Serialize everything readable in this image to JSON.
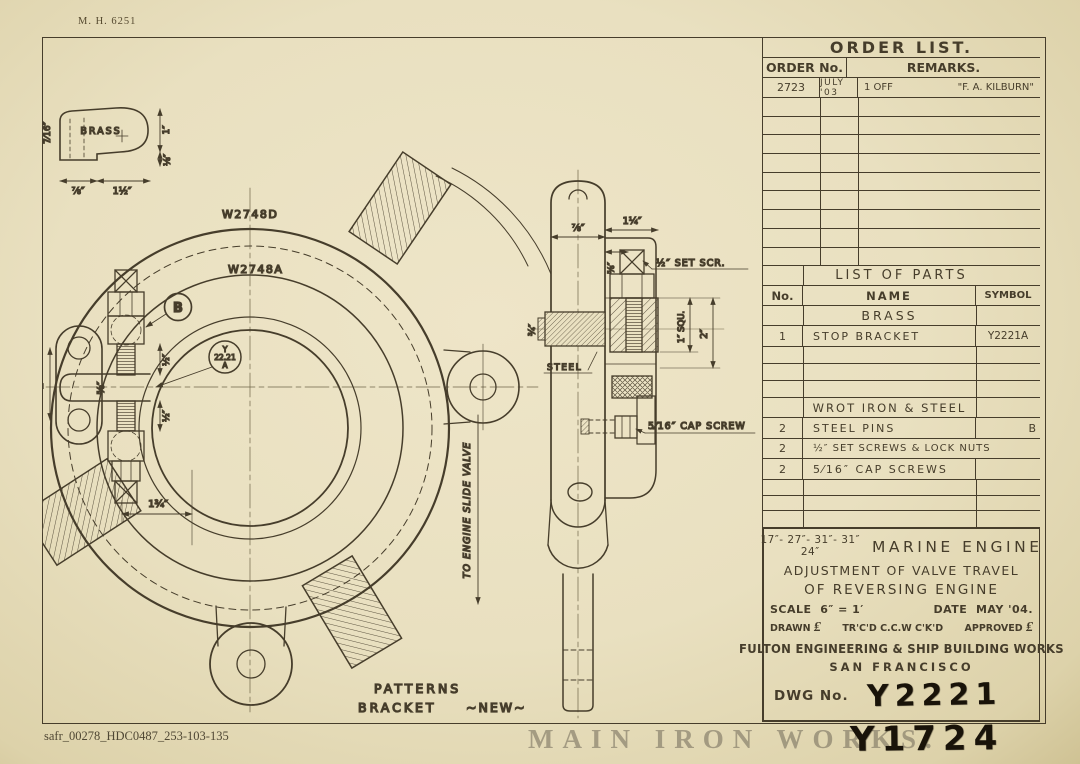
{
  "sheet": {
    "corner_number": "M. H. 6251",
    "archive_code": "safr_00278_HDC0487_253-103-135",
    "watermark": "MAIN IRON WORKS.",
    "stamp_secondary": "Y1724"
  },
  "order_list": {
    "title": "ORDER LIST.",
    "col_order": "ORDER No.",
    "col_remarks": "REMARKS.",
    "entry": {
      "order_no": "2723",
      "date": "JULY '03",
      "qty": "1 OFF",
      "remark": "\"F. A. KILBURN\""
    }
  },
  "parts_list": {
    "title": "LIST OF PARTS",
    "col_no": "No.",
    "col_name": "NAME",
    "col_symbol": "SYMBOL",
    "brass_section": "BRASS",
    "brass_rows": [
      {
        "no": "1",
        "name": "STOP BRACKET",
        "symbol": "Y2221A"
      }
    ],
    "steel_section": "WROT IRON & STEEL",
    "steel_rows": [
      {
        "no": "2",
        "name": "STEEL PINS",
        "symbol": "B"
      },
      {
        "no": "2",
        "name": "½″ SET SCREWS & LOCK NUTS",
        "symbol": ""
      },
      {
        "no": "2",
        "name": "5⁄16″ CAP SCREWS",
        "symbol": ""
      }
    ]
  },
  "title_block": {
    "sizes_top": "17″- 27″- 31″- 31″",
    "sizes_bottom": "24″",
    "machine": "MARINE ENGINE",
    "subject_line1": "ADJUSTMENT OF VALVE TRAVEL",
    "subject_line2": "OF REVERSING ENGINE",
    "scale_label": "SCALE",
    "scale_value": "6″ = 1′",
    "date_label": "DATE",
    "date_value": "MAY '04.",
    "drawn_label": "DRAWN",
    "drawn_sig": "₤",
    "traced": "TR'C'D C.C.W C'K'D",
    "approved_label": "APPROVED",
    "approved_sig": "₤",
    "company": "FULTON ENGINEERING & SHIP BUILDING WORKS",
    "city": "SAN FRANCISCO",
    "dwg_label": "DWG No.",
    "dwg_no": "Y2221"
  },
  "drawing": {
    "brass_detail": {
      "label": "BRASS",
      "dim_height": "7⁄16″",
      "dim_right_top": "1″",
      "dim_right_bottom": "⅛″",
      "dim_bottom_left": "⅞″",
      "dim_bottom_right": "1½″"
    },
    "front_view": {
      "ref_outer": "W2748D",
      "ref_inner": "W2748A",
      "balloon_b": "B",
      "balloon_y_line1": "Y",
      "balloon_y_line2": "22.21",
      "balloon_y_line3": "A",
      "dim_set_screw_upper": "½″",
      "dim_set_screw_lower": "½″",
      "dim_slot": "⅝″",
      "dim_ear": "2″",
      "dim_lug": "1¾″",
      "note_valve": "TO ENGINE SLIDE VALVE"
    },
    "side_view": {
      "dim_width": "⅞″",
      "dim_offset": "1¼″",
      "dim_step": "⅝″",
      "label_set_screw": "½″ SET SCR.",
      "dim_pin": "¾″",
      "label_steel": "STEEL",
      "dim_square": "1″ SQU.",
      "dim_height": "2″",
      "label_cap_screw": "5⁄16″ CAP SCREW"
    },
    "notes": {
      "patterns": "PATTERNS",
      "bracket": "BRACKET",
      "new": "~NEW~"
    }
  }
}
